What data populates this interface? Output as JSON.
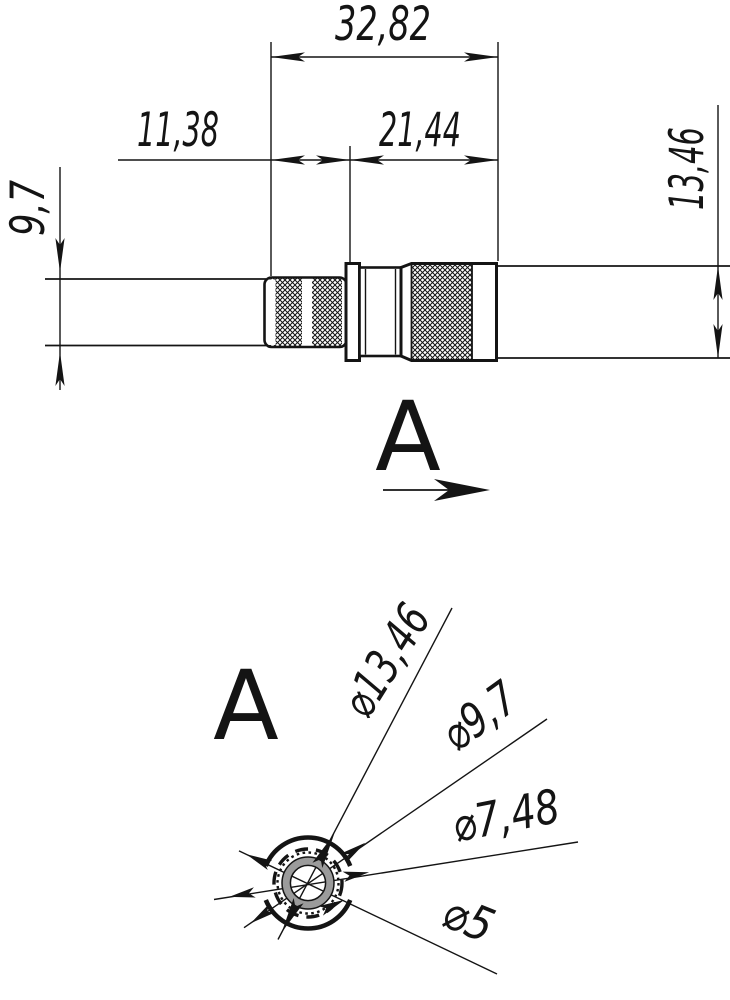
{
  "side_view": {
    "dims": {
      "total_length": "32,82",
      "front_length": "11,38",
      "rear_length": "21,44",
      "cable_diameter": "9,7",
      "body_diameter": "13,46"
    }
  },
  "view_arrow": {
    "label": "A"
  },
  "end_view": {
    "label": "A",
    "dims": {
      "outer_diameter": "⌀13,46",
      "knurl_diameter": "⌀9,7",
      "ring_diameter": "⌀7,48",
      "bore_diameter": "⌀5"
    }
  },
  "colors": {
    "ink": "#141414",
    "ring_fill": "#9b9b9b",
    "paper": "#ffffff"
  }
}
